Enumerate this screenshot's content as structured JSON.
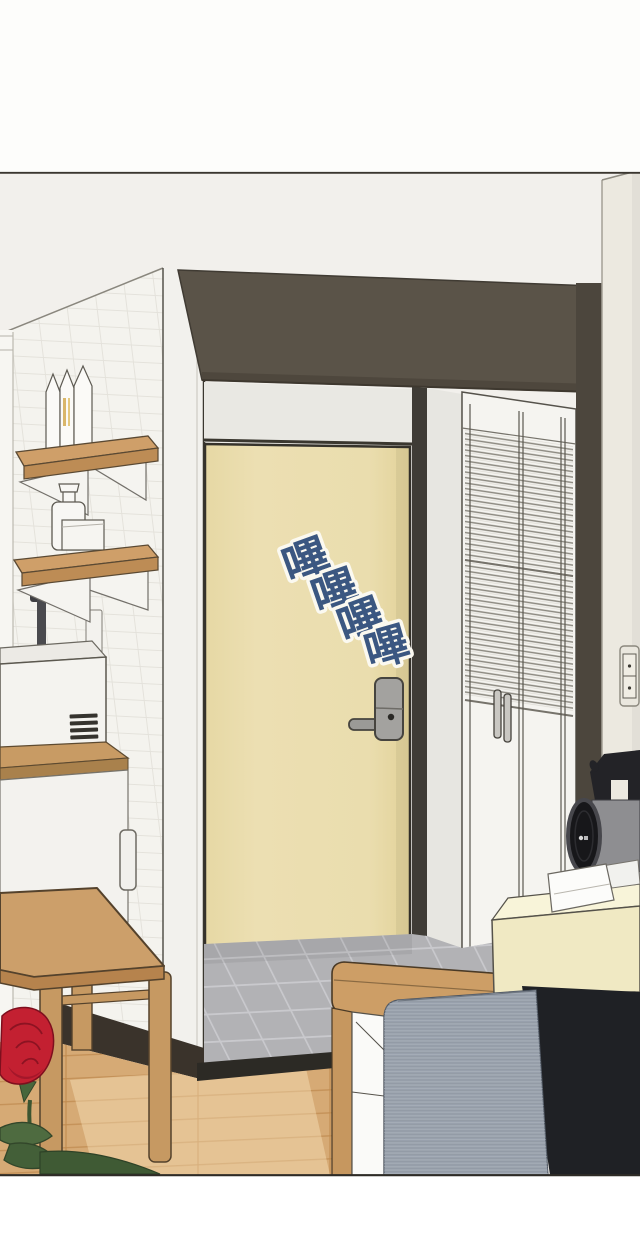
{
  "panel": {
    "kind": "webtoon-interior-panel",
    "scene": "apartment entryway with cream front door, louver closet, shelves and bed",
    "margin_color": "#ffffff",
    "border_color": "#39352e"
  },
  "sfx": {
    "text": "嗶嗶嗶嗶",
    "chars": [
      "嗶",
      "嗶",
      "嗶",
      "嗶"
    ],
    "fill_color": "#3b5781",
    "halo_color": "#fbf9f0"
  },
  "objects": [
    {
      "name": "entry-door",
      "color": "#e9dcab"
    },
    {
      "name": "digital-door-lock",
      "color": "#a3a29f"
    },
    {
      "name": "door-lock-handle",
      "color": "#9b9a97"
    },
    {
      "name": "soffit-beam",
      "color": "#5a5348"
    },
    {
      "name": "tiled-wall",
      "color": "#f4f3ee"
    },
    {
      "name": "wood-shelves",
      "color": "#cf9f69"
    },
    {
      "name": "milk-cartons",
      "color": "#fbfaf7"
    },
    {
      "name": "jar-and-box",
      "color": "#f8f7f4"
    },
    {
      "name": "white-appliance",
      "color": "#f4f3ef"
    },
    {
      "name": "kitchen-counter",
      "color": "#c89b64"
    },
    {
      "name": "cabinet",
      "color": "#f3f2ee"
    },
    {
      "name": "louver-closet",
      "color": "#f5f4f0"
    },
    {
      "name": "dark-wall-strip",
      "color": "#4c463d"
    },
    {
      "name": "corner-pillar",
      "color": "#ece9e0"
    },
    {
      "name": "wall-switch",
      "color": "#eae7de"
    },
    {
      "name": "fan-unit",
      "color": "#17171a"
    },
    {
      "name": "tissue-box",
      "color": "#f0e9c3"
    },
    {
      "name": "bed-frame",
      "color": "#cd9e66"
    },
    {
      "name": "mattress",
      "color": "#9aa2ad"
    },
    {
      "name": "black-cushion",
      "color": "#1f2125"
    },
    {
      "name": "side-table",
      "color": "#cc9f6a"
    },
    {
      "name": "rose",
      "color": "#c32031"
    },
    {
      "name": "entry-tile-floor",
      "color": "#b2b2b5"
    },
    {
      "name": "wood-floor",
      "color": "#d6aa75"
    }
  ]
}
